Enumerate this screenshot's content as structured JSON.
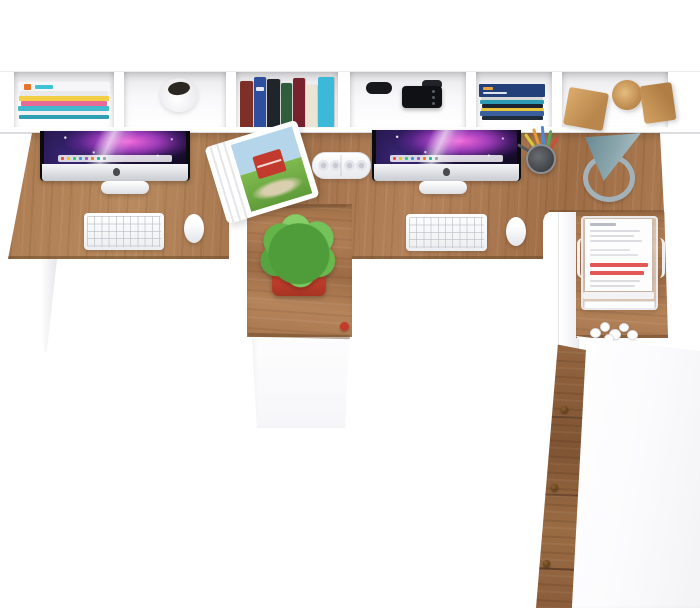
{
  "scene": {
    "title": "Two-person wooden workstation with hutch shelf — top view render",
    "background_color": "#ffffff",
    "shelf": {
      "name": "white wall hutch shelf",
      "color": "#ffffff",
      "compartments": [
        {
          "item": "stack of magazines",
          "strip_colors": [
            "#f6f6f8",
            "#e9e9ec",
            "#f3cf46",
            "#e86a97",
            "#43b9cd",
            "#f1f1f4",
            "#2f9fb3"
          ],
          "logo_color": "#e8742c",
          "accent_color": "#3fc1d6"
        },
        {
          "item": "round white desk cup",
          "opening_color": "#2b2723"
        },
        {
          "item": "row of upright books",
          "spine_colors": [
            "#7e2f28",
            "#2e4f9e",
            "#20242b",
            "#2f5e3c",
            "#77222d",
            "#e9e4d4",
            "#3cb9d9"
          ]
        },
        {
          "item": "black camera and accessories",
          "color": "#101114"
        },
        {
          "item": "flat stack of books",
          "layer_colors": [
            "#23407a",
            "#d8d8d8",
            "#2e9bb5",
            "#1a2430",
            "#e8c53a",
            "#3a5f9e",
            "#202c3c"
          ]
        },
        {
          "item": "wooden decor blocks",
          "count": 3,
          "shapes": [
            "cube",
            "cylinder",
            "cube"
          ],
          "color": "#d0a064"
        }
      ]
    },
    "desk": {
      "name": "double desk worktop",
      "material": "oak wood",
      "wood_color": "#a87a50",
      "leg_color": "#ffffff",
      "cutouts": 2,
      "center_return": {
        "name": "center peninsula return",
        "cabinet_color": "#fbfbfd",
        "knob_color": "#c43b2c"
      },
      "right_return": {
        "name": "right lower return with cabinet",
        "drawer_wood_color": "#8a5c3a",
        "drawer_knob_count": 3,
        "cabinet_top_color": "#ffffff"
      }
    },
    "left_workstation": {
      "computer": "iMac all-in-one",
      "wallpaper": "purple-pink space nebula with white light streak",
      "dock_visible": true,
      "keyboard_color": "#ffffff",
      "mouse_color": "#ffffff"
    },
    "right_workstation": {
      "computer": "iMac all-in-one",
      "wallpaper": "purple-pink space nebula with white light streak",
      "dock_visible": true,
      "keyboard_color": "#ffffff",
      "mouse_color": "#ffffff",
      "pencil_cup": {
        "cup_color": "#4a4d52",
        "pen_colors": [
          "#e89a35",
          "#4f86d8",
          "#55a85b",
          "#d8c93c",
          "#cc4f3c",
          "#555a60"
        ]
      }
    },
    "accessories": {
      "speaker": {
        "name": "white pill speaker",
        "color": "#ffffff",
        "driver_count": 4
      },
      "open_magazine": {
        "name": "open magazine spread",
        "picture": "red barn in green field under blue sky",
        "barn_color": "#c23a2e",
        "sky_color": "#b5d6ea",
        "field_color": "#7fba4e"
      },
      "plant": {
        "name": "potted green plant",
        "foliage_color": "#63b54a",
        "pot_color": "#c7402e"
      },
      "lamp": {
        "name": "desk lamp seen from above",
        "shade_color": "#7d99a1",
        "ring_color": "#a3b2b8"
      },
      "paper_tray": {
        "name": "wire document tray",
        "frame_color": "#ebebee",
        "paper_color": "#fdfdfe",
        "highlight_color": "#e25757",
        "highlight_lines": 2
      },
      "crumpled_paper": {
        "name": "crumpled paper bits",
        "color": "#ffffff"
      }
    }
  }
}
